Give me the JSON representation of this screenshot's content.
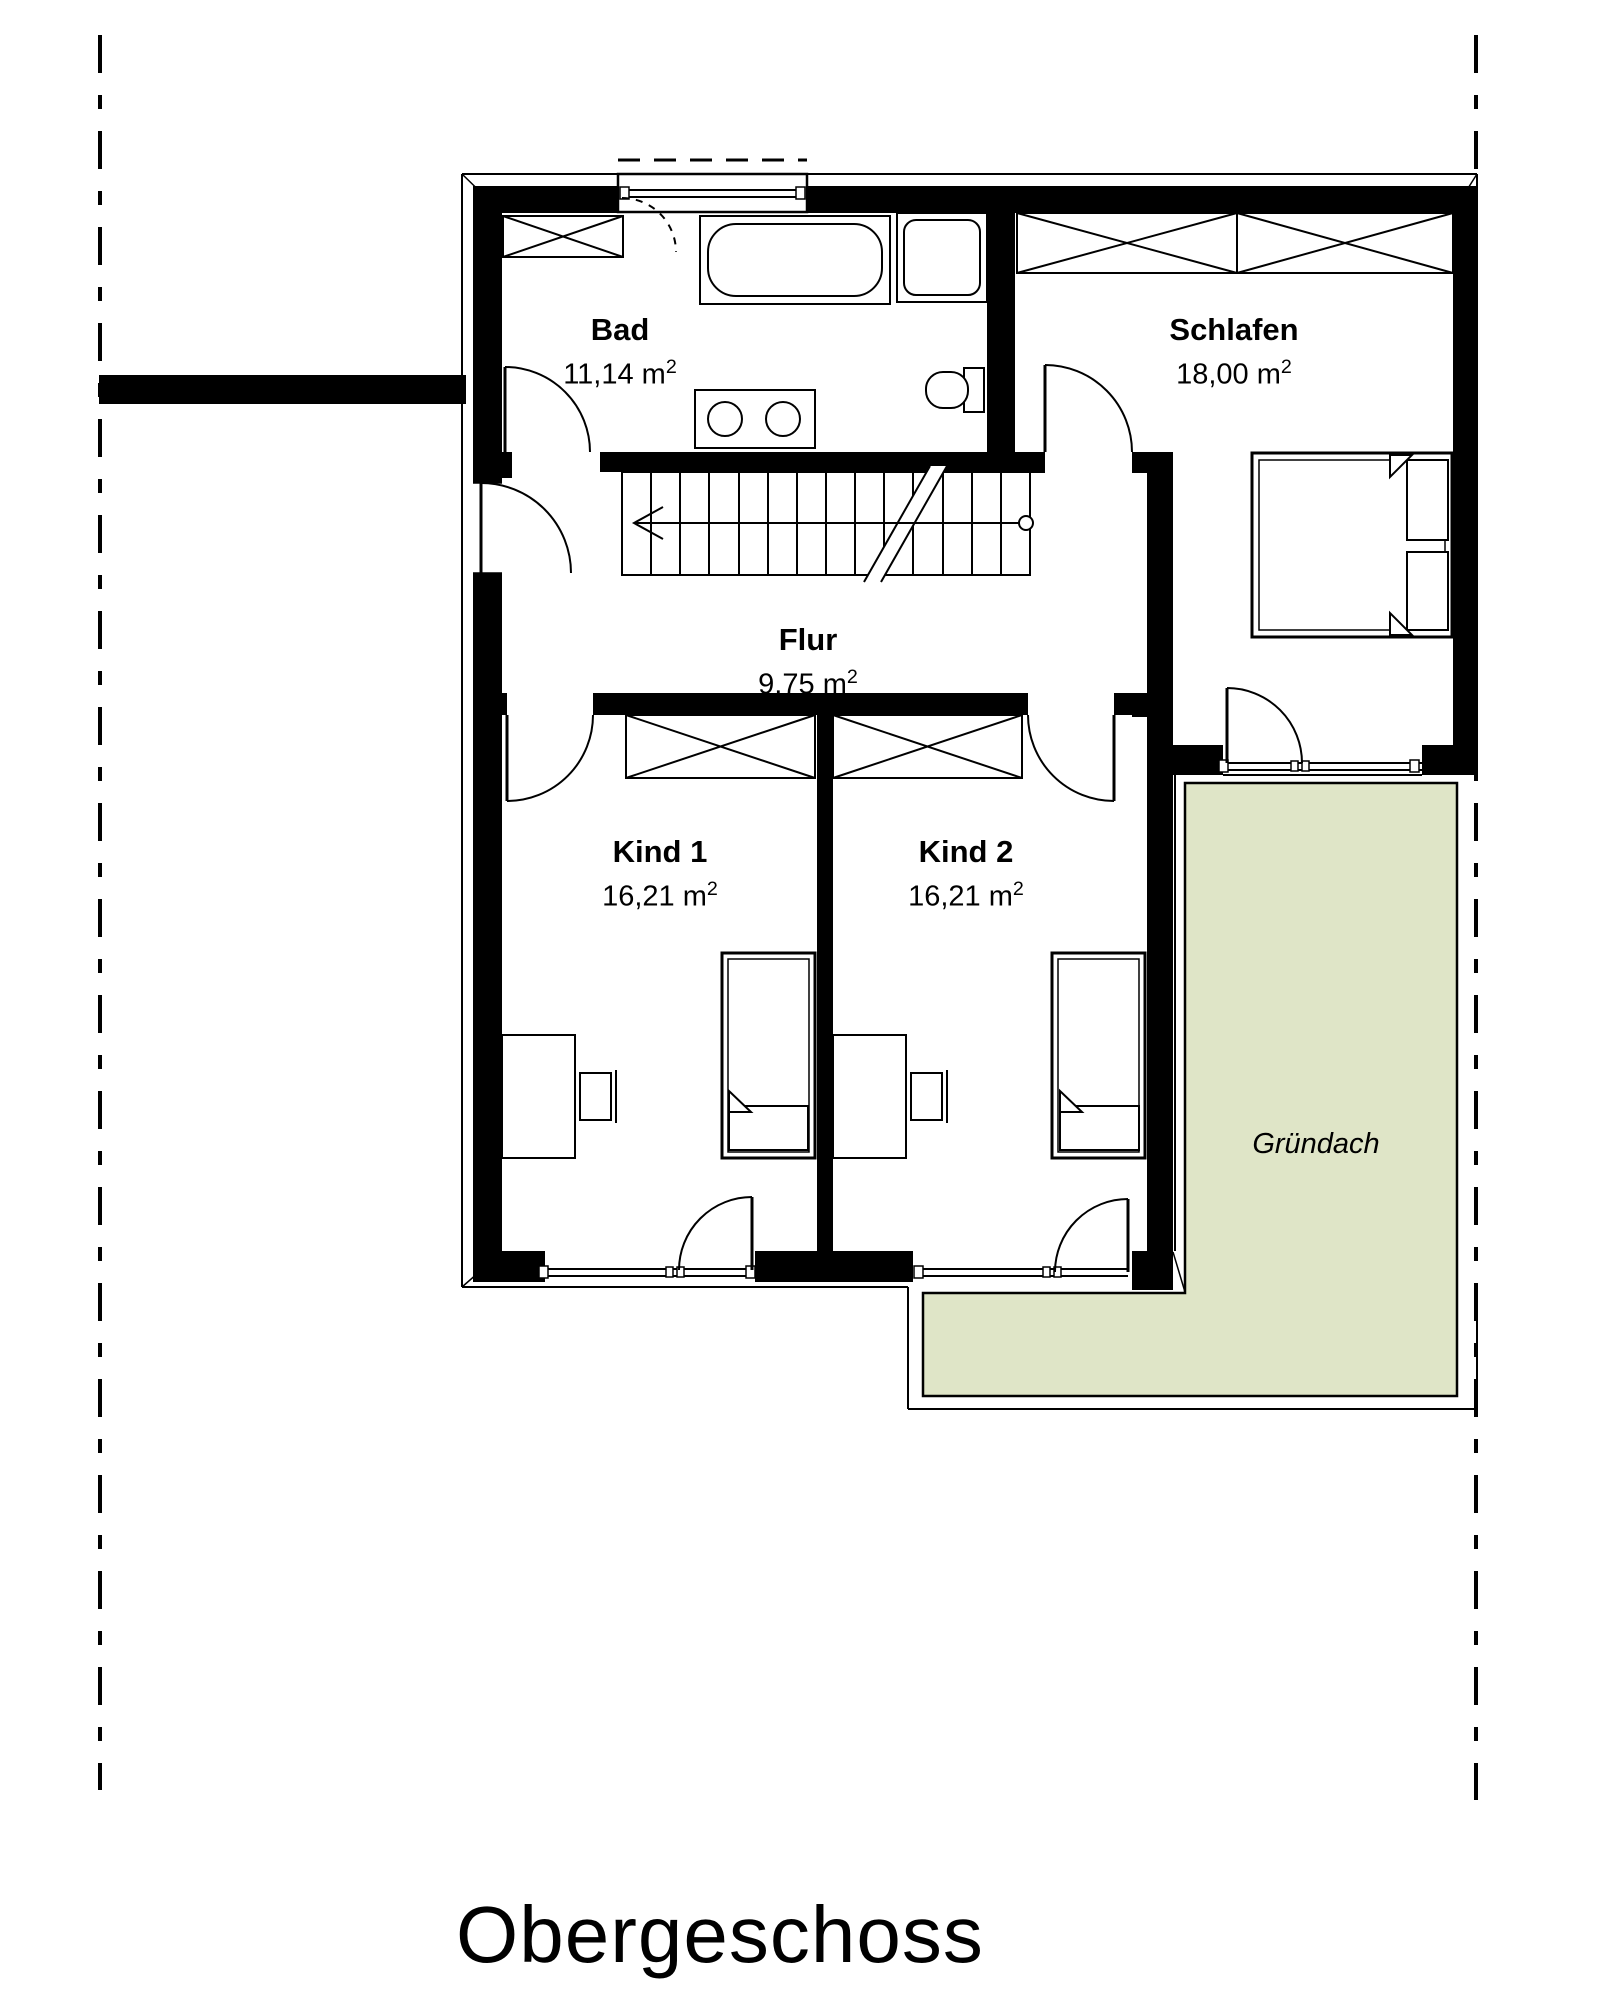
{
  "title": "Obergeschoss",
  "units": {
    "area_unit": "m",
    "area_sup": "2"
  },
  "rooms": [
    {
      "name": "Bad",
      "area": "11,14"
    },
    {
      "name": "Schlafen",
      "area": "18,00"
    },
    {
      "name": "Flur",
      "area": "9,75"
    },
    {
      "name": "Kind 1",
      "area": "16,21"
    },
    {
      "name": "Kind 2",
      "area": "16,21"
    }
  ],
  "roof_area": {
    "label": "Gründach"
  },
  "colors": {
    "green_roof_fill": "#dfe5c7",
    "line": "#000000",
    "paper": "#ffffff"
  }
}
